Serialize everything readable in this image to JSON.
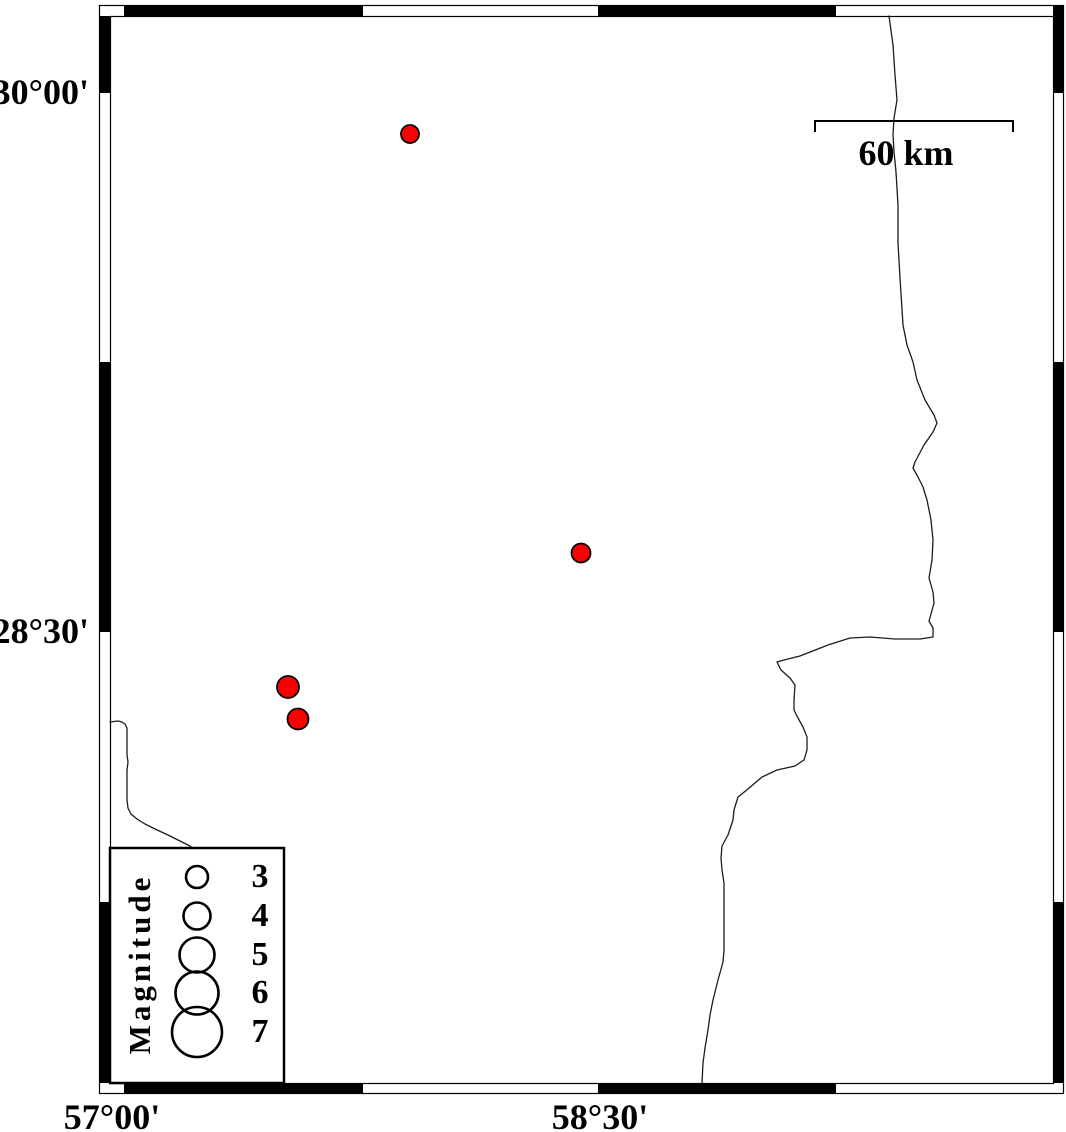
{
  "figure": {
    "type": "seismicity-map",
    "projection_hint": "mercator",
    "lat_labels": [
      {
        "text": "30°00'",
        "y": 92
      },
      {
        "text": "28°30'",
        "y": 631
      }
    ],
    "lon_labels": [
      {
        "text": "57°00'",
        "x": 124
      },
      {
        "text": "58°30'",
        "x": 598
      }
    ],
    "frame": {
      "outer": [
        99,
        5,
        1063,
        1093
      ],
      "inner": [
        110,
        16,
        1053,
        1083
      ],
      "lon_ticks": [
        124,
        362,
        598,
        835
      ],
      "lat_ticks": [
        92,
        362,
        631,
        902
      ],
      "black_top": [
        [
          124,
          362
        ],
        [
          598,
          835
        ],
        [
          1053,
          1063
        ]
      ],
      "black_bottom": [
        [
          124,
          362
        ],
        [
          598,
          835
        ]
      ],
      "black_left": [
        [
          16,
          92
        ],
        [
          362,
          631
        ],
        [
          902,
          1083
        ]
      ],
      "black_right": [
        [
          5,
          92
        ],
        [
          362,
          631
        ],
        [
          902,
          1083
        ]
      ]
    },
    "scale_bar": {
      "label": "60 km",
      "x1": 815,
      "x2": 1013,
      "y": 121,
      "tick_drop": 11
    },
    "earthquakes": [
      {
        "x": 410,
        "y": 134,
        "r": 9,
        "magnitude_approx": 2.6,
        "lon": "≈57°54'",
        "lat": "≈29°53'"
      },
      {
        "x": 581,
        "y": 553,
        "r": 9.5,
        "magnitude_approx": 2.7,
        "lon": "≈58°27'",
        "lat": "≈28°43'"
      },
      {
        "x": 288,
        "y": 687,
        "r": 11,
        "magnitude_approx": 3.3,
        "lon": "≈57°31'",
        "lat": "≈28°21'"
      },
      {
        "x": 298,
        "y": 719,
        "r": 10.5,
        "magnitude_approx": 3.1,
        "lon": "≈57°33'",
        "lat": "≈28°16'"
      }
    ],
    "legend": {
      "title": "Magnitude",
      "box": [
        110,
        848,
        284,
        1083
      ],
      "circle_x": 197,
      "entries": [
        {
          "label": "3",
          "cy": 877,
          "r": 11
        },
        {
          "label": "4",
          "cy": 916,
          "r": 13.5
        },
        {
          "label": "5",
          "cy": 955,
          "r": 17.5
        },
        {
          "label": "6",
          "cy": 993,
          "r": 21.5
        },
        {
          "label": "7",
          "cy": 1032,
          "r": 25
        }
      ]
    },
    "lines": [
      {
        "name": "river-line-main",
        "points": [
          [
            889,
            16
          ],
          [
            893,
            45
          ],
          [
            895,
            75
          ],
          [
            897,
            100
          ],
          [
            894,
            118
          ],
          [
            893,
            135
          ],
          [
            894,
            152
          ],
          [
            896,
            172
          ],
          [
            898,
            205
          ],
          [
            898,
            243
          ],
          [
            900,
            278
          ],
          [
            903,
            325
          ],
          [
            907,
            345
          ],
          [
            913,
            362
          ],
          [
            917,
            380
          ],
          [
            925,
            400
          ],
          [
            934,
            415
          ],
          [
            937,
            423
          ],
          [
            933,
            432
          ],
          [
            924,
            445
          ],
          [
            915,
            462
          ],
          [
            913,
            468
          ],
          [
            918,
            477
          ],
          [
            923,
            487
          ],
          [
            927,
            500
          ],
          [
            931,
            520
          ],
          [
            933,
            540
          ],
          [
            932,
            560
          ],
          [
            929,
            578
          ],
          [
            933,
            592
          ],
          [
            934,
            603
          ],
          [
            931,
            614
          ],
          [
            929,
            621
          ],
          [
            933,
            628
          ],
          [
            933,
            637
          ],
          [
            920,
            639
          ],
          [
            895,
            639
          ],
          [
            870,
            637
          ],
          [
            850,
            638
          ],
          [
            828,
            645
          ],
          [
            800,
            656
          ],
          [
            784,
            660
          ],
          [
            777,
            662
          ],
          [
            781,
            670
          ],
          [
            790,
            678
          ],
          [
            795,
            685
          ],
          [
            794,
            700
          ],
          [
            794,
            710
          ],
          [
            798,
            718
          ],
          [
            803,
            727
          ],
          [
            807,
            737
          ],
          [
            807,
            750
          ],
          [
            804,
            760
          ],
          [
            795,
            766
          ],
          [
            777,
            770
          ],
          [
            762,
            777
          ],
          [
            748,
            789
          ],
          [
            738,
            797
          ],
          [
            734,
            810
          ],
          [
            733,
            820
          ],
          [
            728,
            835
          ],
          [
            722,
            846
          ],
          [
            721,
            858
          ],
          [
            722,
            870
          ],
          [
            724,
            883
          ],
          [
            724,
            920
          ],
          [
            724,
            950
          ],
          [
            723,
            962
          ],
          [
            718,
            980
          ],
          [
            713,
            1000
          ],
          [
            710,
            1015
          ],
          [
            708,
            1030
          ],
          [
            705,
            1048
          ],
          [
            703,
            1063
          ],
          [
            702,
            1083
          ]
        ]
      },
      {
        "name": "river-line-southwest",
        "points": [
          [
            110,
            722
          ],
          [
            118,
            721
          ],
          [
            122,
            722
          ],
          [
            125,
            724
          ],
          [
            127,
            728
          ],
          [
            127,
            742
          ],
          [
            127,
            755
          ],
          [
            128,
            762
          ],
          [
            127,
            770
          ],
          [
            127,
            778
          ],
          [
            127,
            790
          ],
          [
            127,
            800
          ],
          [
            128,
            808
          ],
          [
            131,
            814
          ],
          [
            137,
            819
          ],
          [
            145,
            824
          ],
          [
            155,
            829
          ],
          [
            168,
            835
          ],
          [
            180,
            841
          ],
          [
            190,
            846
          ],
          [
            193,
            849
          ]
        ]
      }
    ]
  },
  "colors": {
    "earthquake_fill": "#fa0000",
    "line": "#1c1c1c",
    "frame": "#000000",
    "background": "#ffffff"
  }
}
